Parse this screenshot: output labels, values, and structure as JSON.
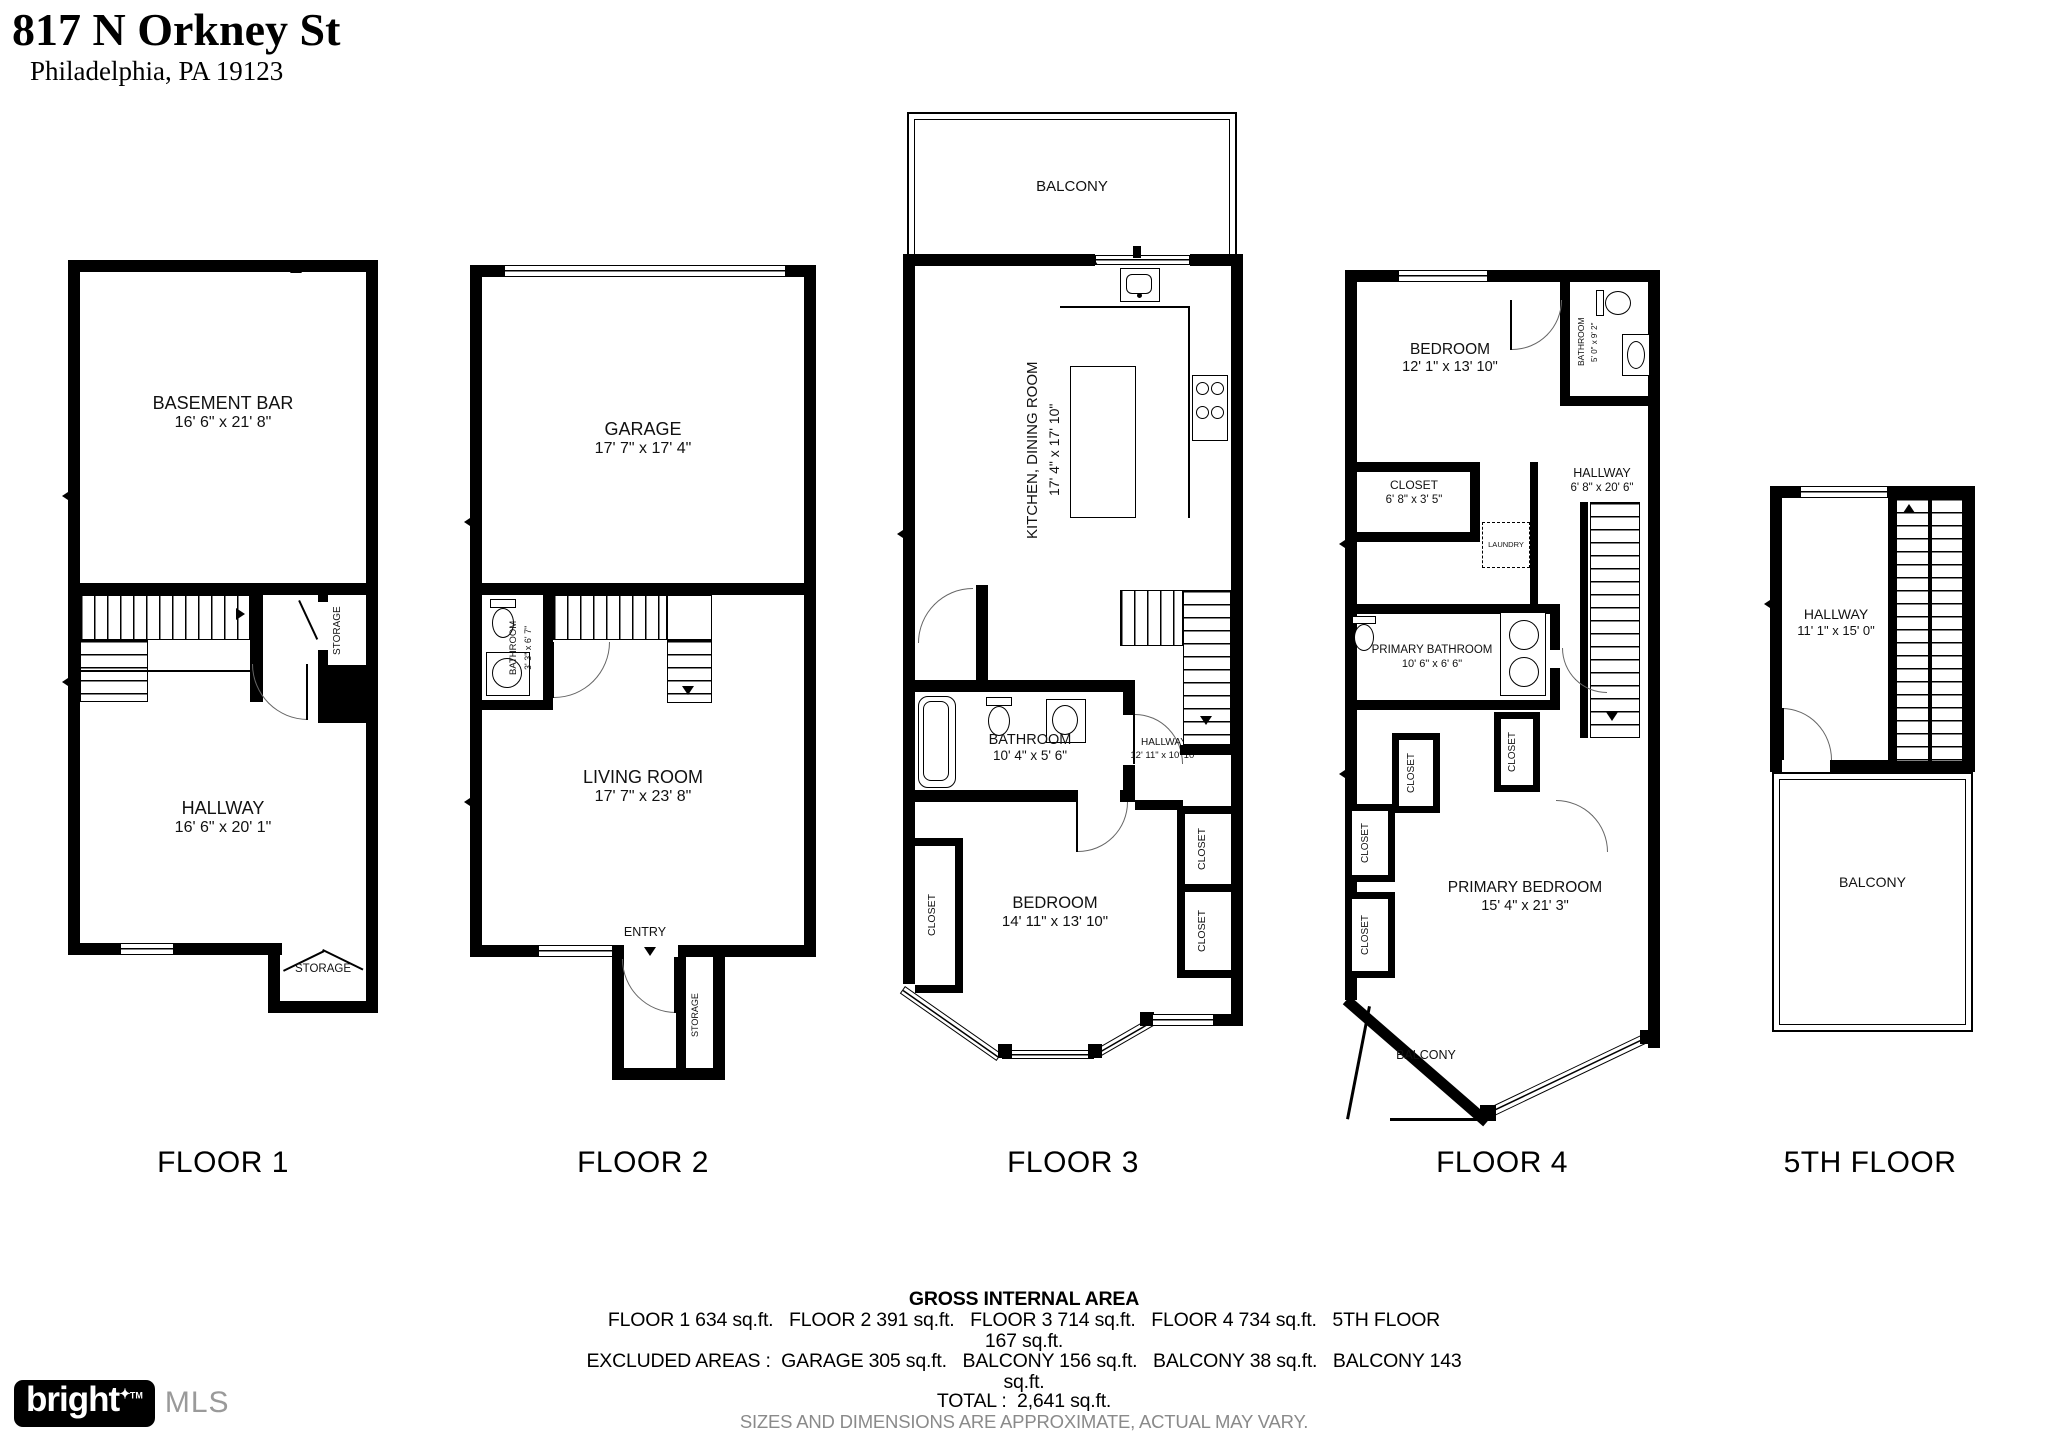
{
  "header": {
    "address": "817 N Orkney St",
    "city": "Philadelphia, PA 19123"
  },
  "floor1": {
    "caption": "FLOOR 1",
    "basement_bar": {
      "name": "BASEMENT BAR",
      "dims": "16' 6\" x 21' 8\""
    },
    "hallway": {
      "name": "HALLWAY",
      "dims": "16' 6\" x 20' 1\""
    },
    "storage_mid": "STORAGE",
    "storage_bottom": "STORAGE"
  },
  "floor2": {
    "caption": "FLOOR 2",
    "garage": {
      "name": "GARAGE",
      "dims": "17' 7\" x 17' 4\""
    },
    "bathroom": {
      "name": "BATHROOM",
      "dims": "3' 3\" x 6' 7\""
    },
    "living_room": {
      "name": "LIVING ROOM",
      "dims": "17' 7\" x 23' 8\""
    },
    "entry": "ENTRY",
    "storage": "STORAGE"
  },
  "floor3": {
    "caption": "FLOOR 3",
    "balcony": "BALCONY",
    "kitchen": {
      "name": "KITCHEN, DINING ROOM",
      "dims": "17' 4\" x 17' 10\""
    },
    "bathroom": {
      "name": "BATHROOM",
      "dims": "10' 4\" x 5' 6\""
    },
    "hallway": {
      "name": "HALLWAY",
      "dims": "12' 11\" x 10' 10\""
    },
    "bedroom": {
      "name": "BEDROOM",
      "dims": "14' 11\" x 13' 10\""
    },
    "closet_left": "CLOSET",
    "closet_right_top": "CLOSET",
    "closet_right_bottom": "CLOSET"
  },
  "floor4": {
    "caption": "FLOOR 4",
    "bedroom": {
      "name": "BEDROOM",
      "dims": "12' 1\" x 13' 10\""
    },
    "bathroom": {
      "name": "BATHROOM",
      "dims": "5' 0\" x 9' 2\""
    },
    "closet_room": {
      "name": "CLOSET",
      "dims": "6' 8\" x 3' 5\""
    },
    "hallway": {
      "name": "HALLWAY",
      "dims": "6' 8\" x 20' 6\""
    },
    "laundry": "LAUNDRY",
    "primary_bathroom": {
      "name": "PRIMARY BATHROOM",
      "dims": "10' 6\" x 6' 6\""
    },
    "closet_mid_left": "CLOSET",
    "closet_mid_right": "CLOSET",
    "closet_left_top": "CLOSET",
    "closet_left_bottom": "CLOSET",
    "primary_bedroom": {
      "name": "PRIMARY BEDROOM",
      "dims": "15' 4\" x 21' 3\""
    },
    "balcony": "BALCONY"
  },
  "floor5": {
    "caption": "5TH FLOOR",
    "hallway": {
      "name": "HALLWAY",
      "dims": "11' 1\" x 15' 0\""
    },
    "balcony": "BALCONY"
  },
  "summary": {
    "title": "GROSS INTERNAL AREA",
    "line1": "FLOOR 1 634 sq.ft.   FLOOR 2 391 sq.ft.   FLOOR 3 714 sq.ft.   FLOOR 4 734 sq.ft.   5TH FLOOR",
    "line2": "167 sq.ft.",
    "line3": "EXCLUDED AREAS :  GARAGE 305 sq.ft.   BALCONY 156 sq.ft.   BALCONY 38 sq.ft.   BALCONY 143",
    "line4": "sq.ft.",
    "total": "TOTAL :  2,641 sq.ft.",
    "disclaimer": "SIZES AND DIMENSIONS ARE APPROXIMATE, ACTUAL MAY VARY."
  },
  "logo": {
    "brand": "bright",
    "star": "✦",
    "tm": "TM",
    "suffix": "MLS"
  }
}
